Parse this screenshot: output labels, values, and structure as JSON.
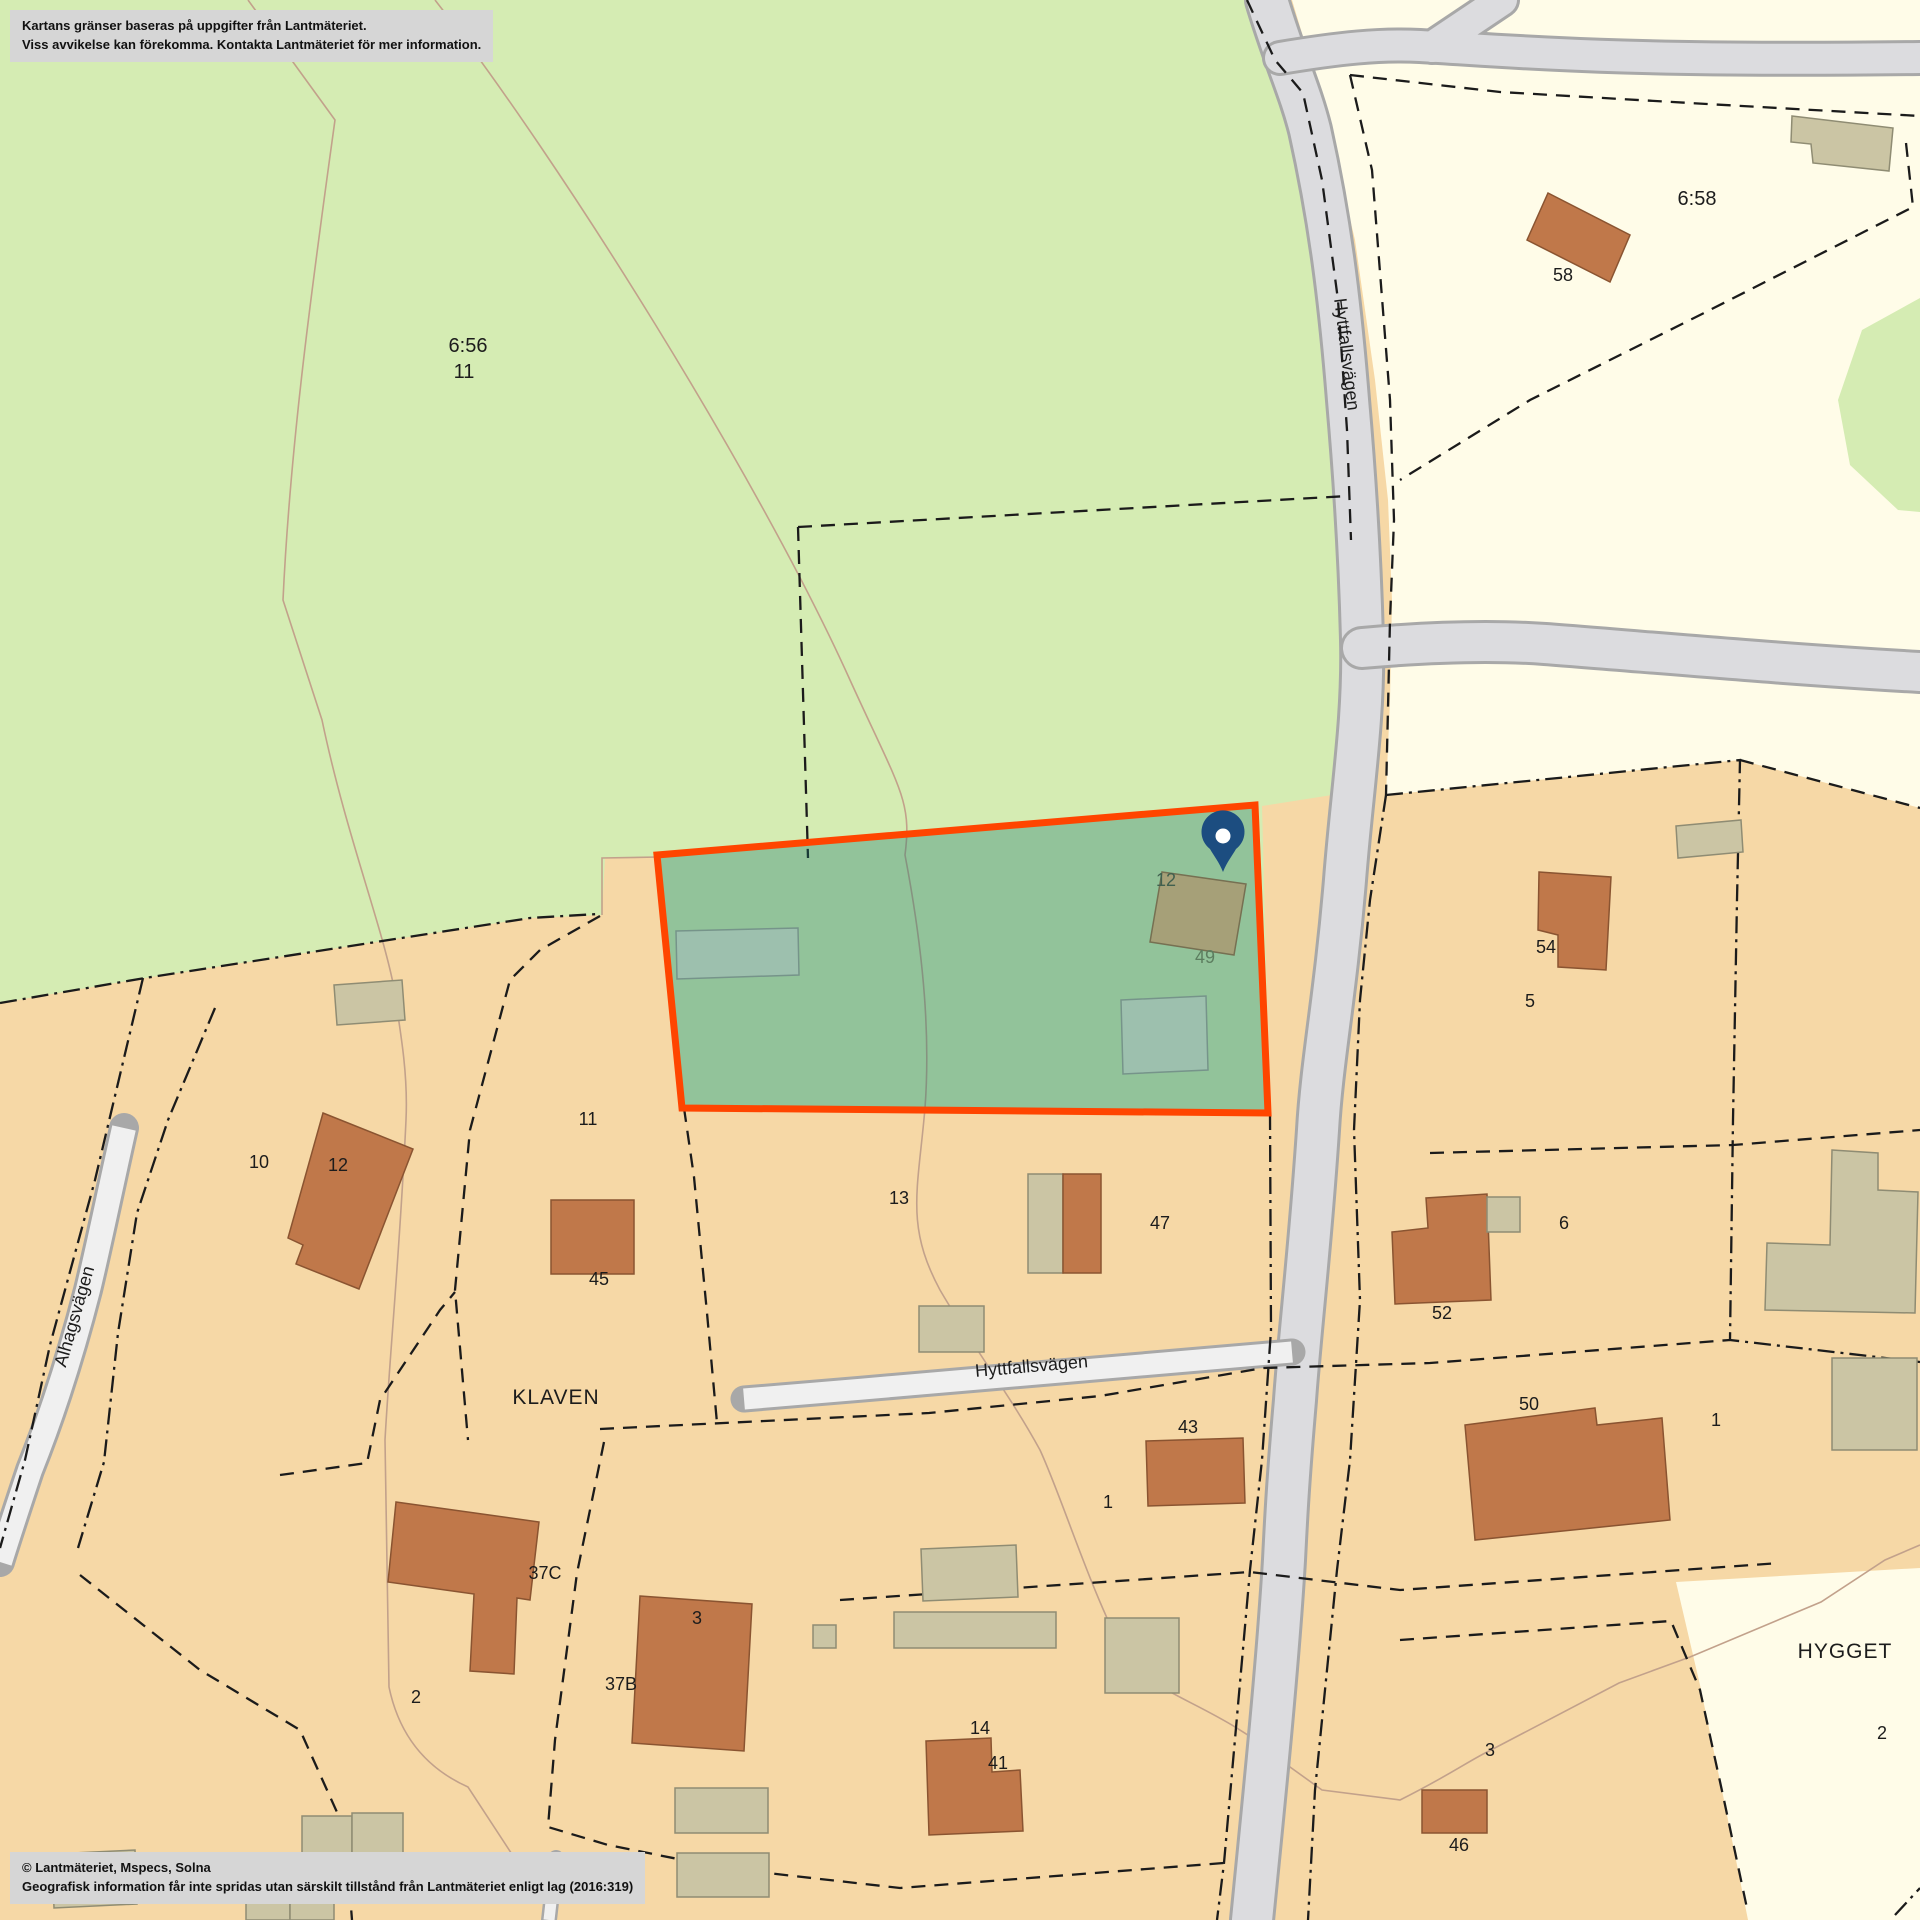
{
  "map": {
    "disclaimer": {
      "line1": "Kartans gränser baseras på uppgifter från Lantmäteriet.",
      "line2": "Viss avvikelse kan förekomma. Kontakta Lantmäteriet för mer information."
    },
    "copyright": {
      "line1": "© Lantmäteriet, Mspecs, Solna",
      "line2": "Geografisk information får inte spridas utan särskilt tillstånd från Lantmäteriet enligt lag (2016:319)"
    },
    "colors": {
      "forest_green": "#d5ecb3",
      "residential_tan": "#f6d8a6",
      "open_land_ivory": "#fffce8",
      "road_gray": "#dcdcdf",
      "building_dwelling": "#c0784a",
      "building_outbuilding": "#cbc5a4",
      "parcel_highlight_border": "#ff4500",
      "parcel_highlight_fill": "rgba(22,120,108,0.35)",
      "pin_blue": "#1c4d80",
      "boundary_black": "#1b1b1b"
    },
    "highlighted_parcel": {
      "points": "657,855 1255,805 1268,1113 682,1108",
      "fill": "rgba(22,120,108,0.35)",
      "border": "#ff4500",
      "border_width": 7
    },
    "pin": {
      "x": 1223,
      "y": 872,
      "color": "#1c4d80"
    },
    "labels": [
      {
        "id": "prop-6-56",
        "text": "6:56",
        "x": 468,
        "y": 352,
        "size": 20
      },
      {
        "id": "prop-6-56b",
        "text": "11",
        "x": 464,
        "y": 378,
        "size": 20
      },
      {
        "id": "prop-6-58",
        "text": "6:58",
        "x": 1697,
        "y": 205,
        "size": 20
      },
      {
        "id": "house-58",
        "text": "58",
        "x": 1563,
        "y": 281,
        "size": 18
      },
      {
        "id": "road-hyttfallsvagen-n",
        "text": "Hyttfallsvägen",
        "x": 1341,
        "y": 355,
        "size": 18,
        "rotate": 83
      },
      {
        "id": "house-12-parcel",
        "text": "12",
        "x": 1166,
        "y": 886,
        "size": 18,
        "color": "#41604f"
      },
      {
        "id": "house-49-parcel",
        "text": "49",
        "x": 1205,
        "y": 963,
        "size": 18,
        "color": "#5c7d5f"
      },
      {
        "id": "house-10",
        "text": "10",
        "x": 259,
        "y": 1168,
        "size": 18
      },
      {
        "id": "house-12w",
        "text": "12",
        "x": 338,
        "y": 1171,
        "size": 18
      },
      {
        "id": "parcel-11",
        "text": "11",
        "x": 588,
        "y": 1125,
        "size": 18
      },
      {
        "id": "house-45",
        "text": "45",
        "x": 599,
        "y": 1285,
        "size": 18
      },
      {
        "id": "parcel-13",
        "text": "13",
        "x": 899,
        "y": 1204,
        "size": 18
      },
      {
        "id": "house-47",
        "text": "47",
        "x": 1160,
        "y": 1229,
        "size": 18
      },
      {
        "id": "road-alhagsvagen",
        "text": "Alhagsvägen",
        "x": 80,
        "y": 1318,
        "size": 18,
        "rotate": -74
      },
      {
        "id": "area-klaven",
        "text": "KLAVEN",
        "x": 556,
        "y": 1404,
        "size": 21,
        "spacing": 1
      },
      {
        "id": "road-hyttfallsvagen-s",
        "text": "Hyttfallsvägen",
        "x": 1032,
        "y": 1372,
        "size": 18,
        "rotate": -5
      },
      {
        "id": "house-43",
        "text": "43",
        "x": 1188,
        "y": 1433,
        "size": 18
      },
      {
        "id": "parcel-1w",
        "text": "1",
        "x": 1108,
        "y": 1508,
        "size": 18
      },
      {
        "id": "house-52",
        "text": "52",
        "x": 1442,
        "y": 1319,
        "size": 18
      },
      {
        "id": "parcel-6",
        "text": "6",
        "x": 1564,
        "y": 1229,
        "size": 18
      },
      {
        "id": "house-54",
        "text": "54",
        "x": 1546,
        "y": 953,
        "size": 18
      },
      {
        "id": "parcel-5",
        "text": "5",
        "x": 1530,
        "y": 1007,
        "size": 18
      },
      {
        "id": "house-50",
        "text": "50",
        "x": 1529,
        "y": 1410,
        "size": 18
      },
      {
        "id": "parcel-1e",
        "text": "1",
        "x": 1716,
        "y": 1426,
        "size": 18
      },
      {
        "id": "area-hygget",
        "text": "HYGGET",
        "x": 1845,
        "y": 1658,
        "size": 21,
        "spacing": 1
      },
      {
        "id": "parcel-2e",
        "text": "2",
        "x": 1882,
        "y": 1739,
        "size": 18
      },
      {
        "id": "parcel-3e",
        "text": "3",
        "x": 1490,
        "y": 1756,
        "size": 18
      },
      {
        "id": "house-46",
        "text": "46",
        "x": 1459,
        "y": 1851,
        "size": 18
      },
      {
        "id": "house-37c",
        "text": "37C",
        "x": 545,
        "y": 1579,
        "size": 18
      },
      {
        "id": "parcel-2w",
        "text": "2",
        "x": 416,
        "y": 1703,
        "size": 18
      },
      {
        "id": "house-3w",
        "text": "3",
        "x": 697,
        "y": 1624,
        "size": 18
      },
      {
        "id": "house-37b",
        "text": "37B",
        "x": 621,
        "y": 1690,
        "size": 18
      },
      {
        "id": "house-14",
        "text": "14",
        "x": 980,
        "y": 1734,
        "size": 18
      },
      {
        "id": "house-41",
        "text": "41",
        "x": 998,
        "y": 1769,
        "size": 18
      }
    ]
  }
}
